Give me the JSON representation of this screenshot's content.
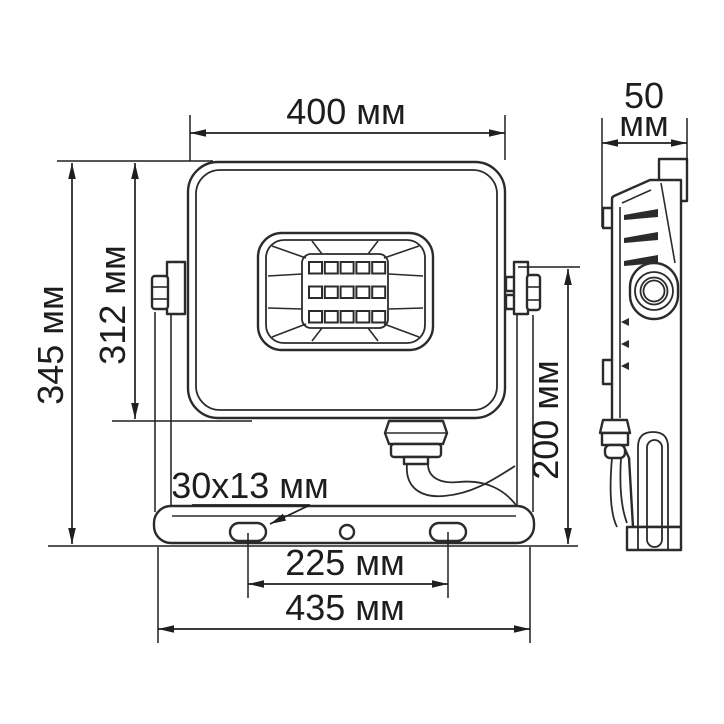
{
  "drawing": {
    "colors": {
      "background": "#ffffff",
      "line": "#2b2b2b",
      "text": "#1d1d1d"
    },
    "labels": {
      "front_width": "400 мм",
      "depth_value": "50",
      "depth_unit": "мм",
      "total_height": "345 мм",
      "body_height": "312 мм",
      "bracket_height": "200 мм",
      "mount_slot": "30x13 мм",
      "slot_spacing": "225 мм",
      "bracket_width": "435 мм"
    }
  }
}
